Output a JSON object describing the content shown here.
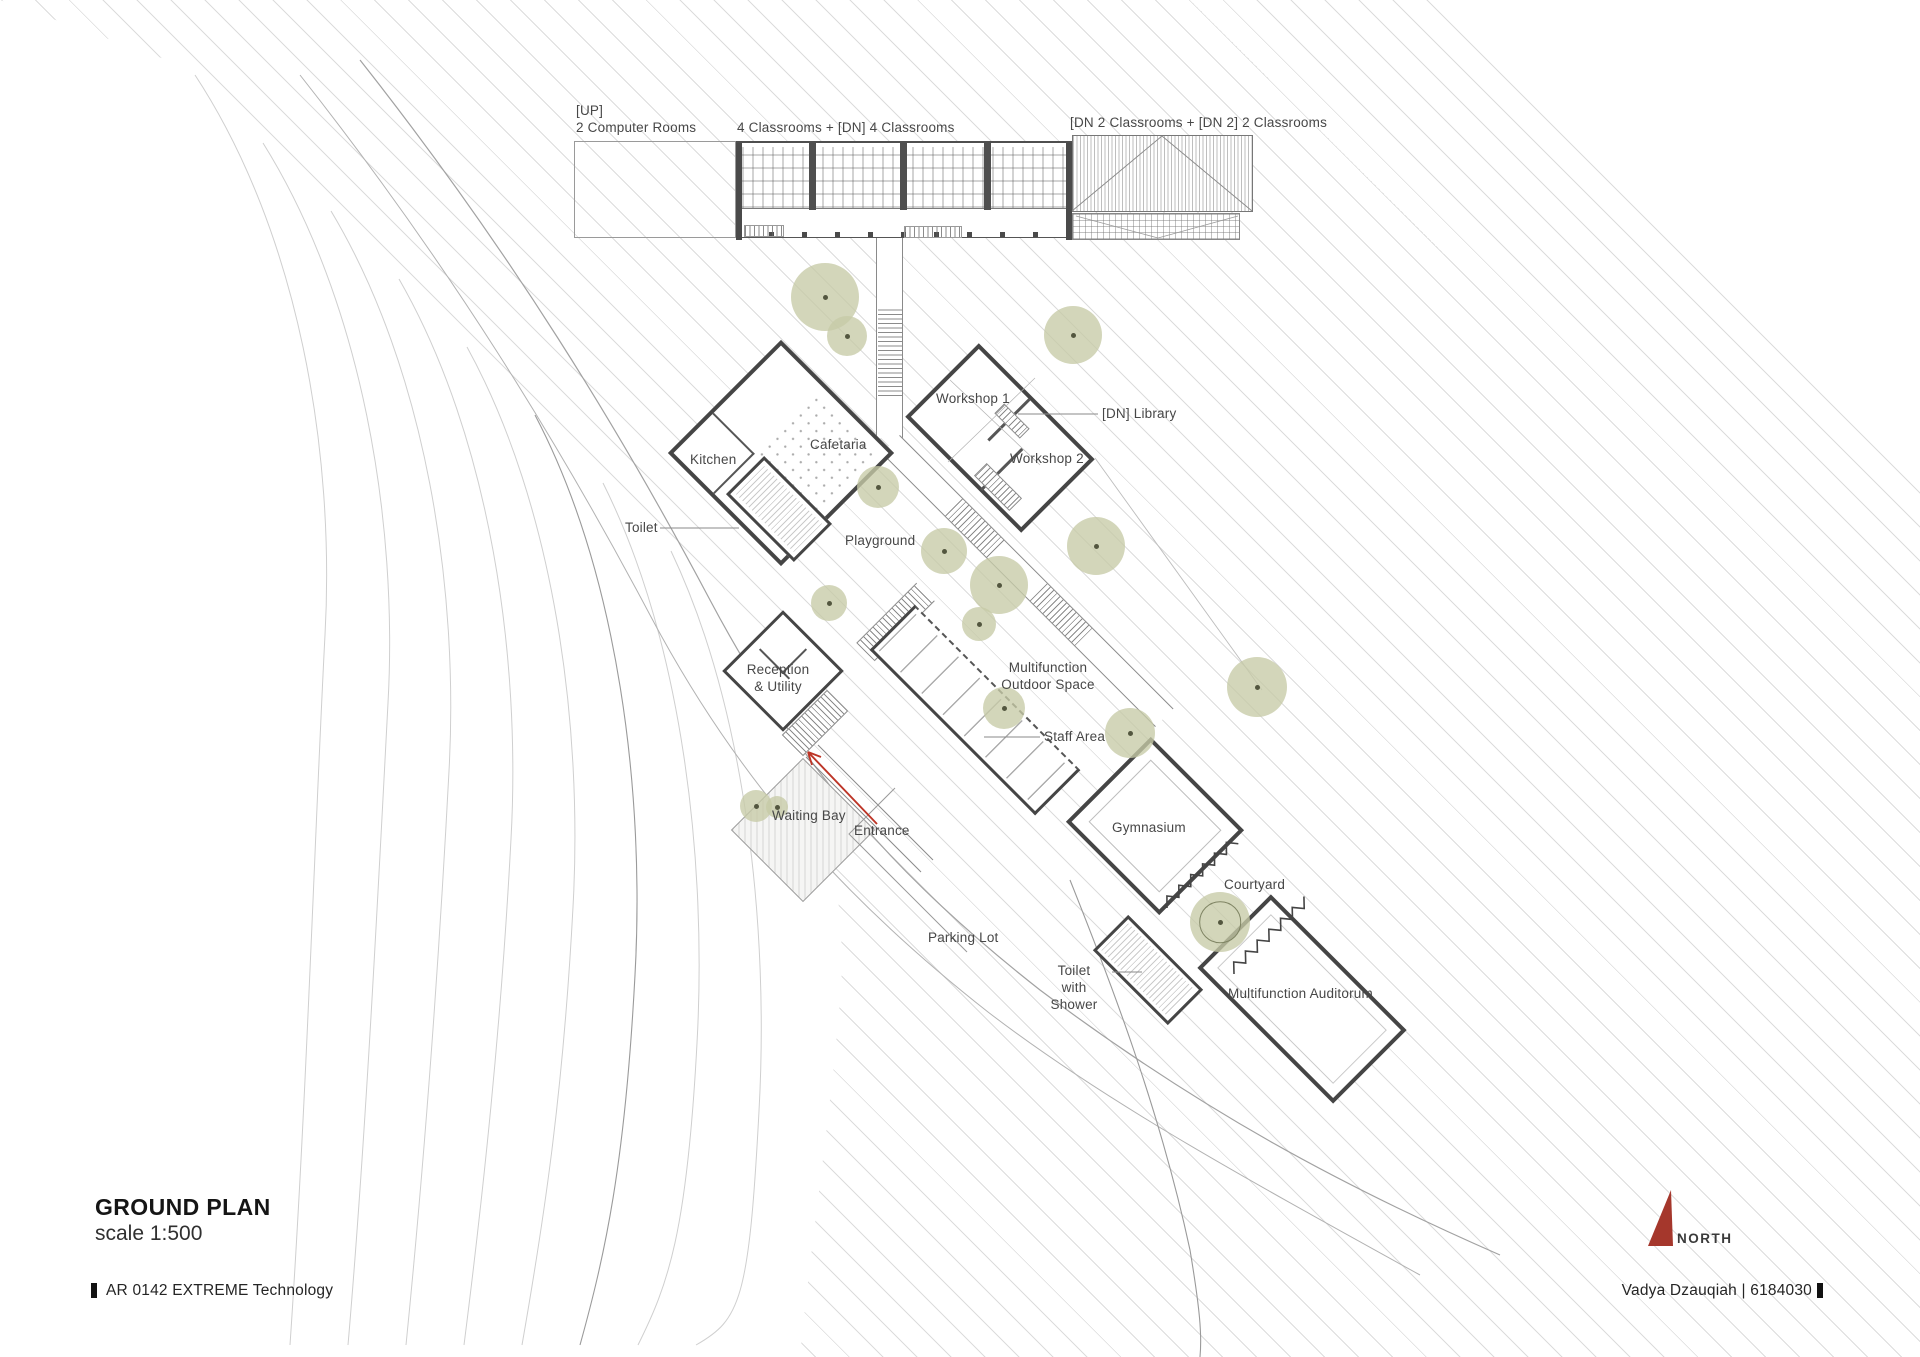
{
  "title_block": {
    "title": "GROUND PLAN",
    "scale": "scale 1:500"
  },
  "footer": {
    "project": "AR 0142 EXTREME Technology",
    "author": "Vadya Dzauqiah | 6184030"
  },
  "compass": {
    "label": "NORTH"
  },
  "labels": {
    "computer_rooms": "[UP]\n2 Computer Rooms",
    "classrooms_center": "4 Classrooms + [DN] 4 Classrooms",
    "classrooms_east": "[DN 2 Classrooms + [DN 2] 2 Classrooms",
    "workshop_1": "Workshop 1",
    "library": "[DN] Library",
    "workshop_2": "Workshop 2",
    "cafetaria": "Cafetaria",
    "kitchen": "Kitchen",
    "toilet": "Toilet",
    "playground": "Playground",
    "reception": "Reception\n& Utility",
    "outdoor_space": "Multifunction\nOutdoor Space",
    "staff_area": "Staff Area",
    "waiting_bay": "Waiting Bay",
    "entrance": "Entrance",
    "parking_lot": "Parking Lot",
    "gymnasium": "Gymnasium",
    "courtyard": "Courtyard",
    "toilet_shower": "Toilet\nwith Shower",
    "auditorium": "Multifunction Auditorum"
  },
  "colors": {
    "north_arrow": "#a5372c",
    "entrance_arrow": "#bd3527",
    "tree": "#c6cba6",
    "wall": "#454545",
    "hatch_line": "#dcdcdc"
  }
}
